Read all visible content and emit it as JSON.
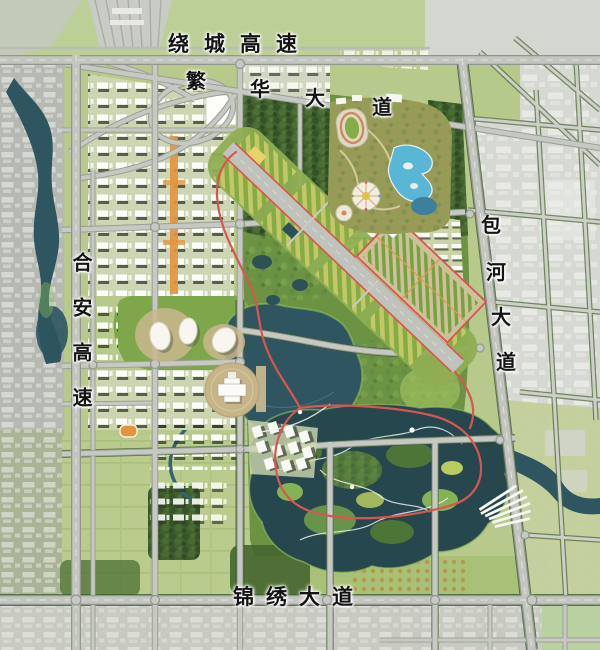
{
  "map": {
    "kind": "urban-master-plan-rendering",
    "labels": {
      "ring_expressway": "绕城高速",
      "fanhua_avenue": "繁华大道",
      "hean_expressway": "合安高速",
      "baohe_avenue": "包河大道",
      "jinxiu_avenue": "锦绣大道"
    },
    "colors": {
      "park_green": "#4a6a33",
      "field_green": "#b7c98b",
      "water_teal": "#2e5560",
      "road_gray": "#c3c5bf",
      "existing_city_gray": "#d6d8d2",
      "trail_red": "#d95550",
      "axis_orange": "#e2953f",
      "label_ink": "#141414"
    }
  }
}
